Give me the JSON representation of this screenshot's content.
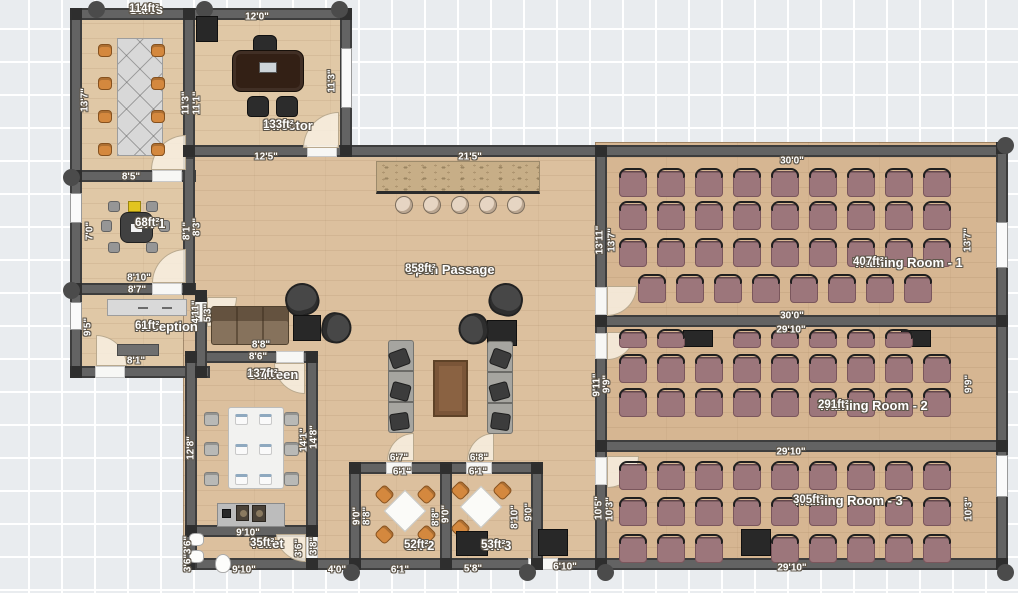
{
  "plan": {
    "title": "Office Floor Plan",
    "colors": {
      "canvas": "#e9ecef",
      "grid_line": "#ffffff",
      "wall": "#636363",
      "post": "#2e2e2e",
      "floor_offices": "#e0c8a6",
      "floor_passage": "#dcc09e",
      "floor_training": "#d6b692",
      "training_chair": "#9c767b",
      "orange_chair": "#d4883e",
      "accent_yellow": "#e2c41f",
      "label_text": "#ffffff",
      "label_outline": "#5f574b"
    },
    "rooms": [
      {
        "name": "Sales",
        "area": "114ft²",
        "cx": 129,
        "top": 3
      },
      {
        "name": "Director",
        "area": "133ft²",
        "cx": 263,
        "top": 119
      },
      {
        "name": "CR-1",
        "area": "68ft²",
        "cx": 135,
        "top": 217
      },
      {
        "name": "Reception",
        "area": "61ft²",
        "cx": 135,
        "top": 320
      },
      {
        "name": "Canteen",
        "area": "137ft²",
        "cx": 247,
        "top": 368
      },
      {
        "name": "Open Passage",
        "area": "858ft²",
        "cx": 405,
        "top": 263
      },
      {
        "name": "Toilet",
        "area": "35ft²",
        "cx": 250,
        "top": 537
      },
      {
        "name": "CR-2",
        "area": "52ft²",
        "cx": 404,
        "top": 539
      },
      {
        "name": "CR-3",
        "area": "53ft²",
        "cx": 481,
        "top": 539
      },
      {
        "name": "Training Room - 1",
        "area": "407ft²",
        "cx": 853,
        "top": 256
      },
      {
        "name": "Training Room - 2",
        "area": "291ft²",
        "cx": 818,
        "top": 399
      },
      {
        "name": "Training Room - 3",
        "area": "305ft²",
        "cx": 793,
        "top": 494
      }
    ],
    "dimensions": [
      {
        "text": "12'0\"",
        "x": 257,
        "y": 17,
        "vert": false
      },
      {
        "text": "12'5\"",
        "x": 266,
        "y": 157,
        "vert": false
      },
      {
        "text": "8'5\"",
        "x": 131,
        "y": 177,
        "vert": false
      },
      {
        "text": "8'10\"",
        "x": 139,
        "y": 278,
        "vert": false
      },
      {
        "text": "8'7\"",
        "x": 137,
        "y": 290,
        "vert": false
      },
      {
        "text": "8'1\"",
        "x": 136,
        "y": 361,
        "vert": false
      },
      {
        "text": "8'8\"",
        "x": 261,
        "y": 345,
        "vert": false
      },
      {
        "text": "8'6\"",
        "x": 258,
        "y": 357,
        "vert": false
      },
      {
        "text": "9'10\"",
        "x": 248,
        "y": 533,
        "vert": false
      },
      {
        "text": "9'10\"",
        "x": 244,
        "y": 570,
        "vert": false
      },
      {
        "text": "4'0\"",
        "x": 337,
        "y": 570,
        "vert": false
      },
      {
        "text": "6'1\"",
        "x": 400,
        "y": 570,
        "vert": false
      },
      {
        "text": "5'8\"",
        "x": 473,
        "y": 569,
        "vert": false
      },
      {
        "text": "6'10\"",
        "x": 565,
        "y": 567,
        "vert": false
      },
      {
        "text": "6'7\"",
        "x": 399,
        "y": 458,
        "vert": false
      },
      {
        "text": "6'1\"",
        "x": 402,
        "y": 472,
        "vert": false
      },
      {
        "text": "6'8\"",
        "x": 479,
        "y": 458,
        "vert": false
      },
      {
        "text": "6'1\"",
        "x": 478,
        "y": 472,
        "vert": false
      },
      {
        "text": "21'5\"",
        "x": 470,
        "y": 157,
        "vert": false
      },
      {
        "text": "30'0\"",
        "x": 792,
        "y": 161,
        "vert": false
      },
      {
        "text": "30'0\"",
        "x": 792,
        "y": 316,
        "vert": false
      },
      {
        "text": "29'10\"",
        "x": 791,
        "y": 330,
        "vert": false
      },
      {
        "text": "29'10\"",
        "x": 791,
        "y": 452,
        "vert": false
      },
      {
        "text": "29'10\"",
        "x": 792,
        "y": 568,
        "vert": false
      },
      {
        "text": "13'7\"",
        "x": 85,
        "y": 100,
        "vert": true
      },
      {
        "text": "11'3\"",
        "x": 186,
        "y": 103,
        "vert": true
      },
      {
        "text": "11'1\"",
        "x": 197,
        "y": 103,
        "vert": true
      },
      {
        "text": "11'3\"",
        "x": 332,
        "y": 81,
        "vert": true
      },
      {
        "text": "7'0\"",
        "x": 90,
        "y": 231,
        "vert": true
      },
      {
        "text": "8'1\"",
        "x": 187,
        "y": 231,
        "vert": true
      },
      {
        "text": "8'3\"",
        "x": 197,
        "y": 227,
        "vert": true
      },
      {
        "text": "9'5\"",
        "x": 88,
        "y": 327,
        "vert": true
      },
      {
        "text": "4'11\"",
        "x": 196,
        "y": 312,
        "vert": true
      },
      {
        "text": "5'3\"",
        "x": 208,
        "y": 313,
        "vert": true
      },
      {
        "text": "12'8\"",
        "x": 191,
        "y": 448,
        "vert": true
      },
      {
        "text": "14'1\"",
        "x": 304,
        "y": 440,
        "vert": true
      },
      {
        "text": "14'8\"",
        "x": 314,
        "y": 437,
        "vert": true
      },
      {
        "text": "3'6\"",
        "x": 188,
        "y": 545,
        "vert": true
      },
      {
        "text": "3'6\"",
        "x": 188,
        "y": 563,
        "vert": true
      },
      {
        "text": "3'6\"",
        "x": 299,
        "y": 548,
        "vert": true
      },
      {
        "text": "3'8\"",
        "x": 314,
        "y": 546,
        "vert": true
      },
      {
        "text": "9'0\"",
        "x": 357,
        "y": 516,
        "vert": true
      },
      {
        "text": "8'8\"",
        "x": 367,
        "y": 516,
        "vert": true
      },
      {
        "text": "8'8\"",
        "x": 436,
        "y": 517,
        "vert": true
      },
      {
        "text": "9'0\"",
        "x": 446,
        "y": 514,
        "vert": true
      },
      {
        "text": "8'10\"",
        "x": 515,
        "y": 517,
        "vert": true
      },
      {
        "text": "9'0\"",
        "x": 529,
        "y": 512,
        "vert": true
      },
      {
        "text": "13'11\"",
        "x": 600,
        "y": 240,
        "vert": true
      },
      {
        "text": "13'7\"",
        "x": 612,
        "y": 240,
        "vert": true
      },
      {
        "text": "13'7\"",
        "x": 968,
        "y": 240,
        "vert": true
      },
      {
        "text": "9'11\"",
        "x": 597,
        "y": 385,
        "vert": true
      },
      {
        "text": "9'9\"",
        "x": 607,
        "y": 384,
        "vert": true
      },
      {
        "text": "9'9\"",
        "x": 969,
        "y": 384,
        "vert": true
      },
      {
        "text": "10'5\"",
        "x": 599,
        "y": 508,
        "vert": true
      },
      {
        "text": "10'3\"",
        "x": 610,
        "y": 509,
        "vert": true
      },
      {
        "text": "10'3\"",
        "x": 969,
        "y": 509,
        "vert": true
      }
    ],
    "training": {
      "chair_w": 28,
      "chair_h": 26,
      "cols": [
        619,
        657,
        695,
        733,
        771,
        809,
        847,
        885,
        923
      ],
      "rows": [
        {
          "y": 171,
          "cols": [
            0,
            1,
            2,
            3,
            4,
            5,
            6,
            7,
            8
          ]
        },
        {
          "y": 204,
          "cols": [
            0,
            1,
            2,
            3,
            4,
            5,
            6,
            7,
            8
          ]
        },
        {
          "y": 241,
          "cols": [
            0,
            1,
            2,
            3,
            4,
            5,
            6,
            7,
            8
          ]
        },
        {
          "y": 277,
          "offset": 19,
          "cols": [
            0,
            1,
            2,
            3,
            4,
            5,
            6,
            7
          ]
        },
        {
          "y": 332,
          "h": 16,
          "cols": [
            0,
            1,
            3,
            4,
            5,
            6,
            7
          ]
        },
        {
          "y": 357,
          "cols": [
            0,
            1,
            2,
            3,
            4,
            5,
            6,
            7,
            8
          ]
        },
        {
          "y": 391,
          "cols": [
            0,
            1,
            2,
            3,
            4,
            5,
            6,
            7,
            8
          ]
        },
        {
          "y": 464,
          "cols": [
            0,
            1,
            2,
            3,
            4,
            5,
            6,
            7,
            8
          ]
        },
        {
          "y": 500,
          "cols": [
            0,
            1,
            2,
            3,
            4,
            5,
            6,
            7,
            8
          ]
        },
        {
          "y": 537,
          "cols": [
            0,
            1,
            2,
            4,
            5,
            6,
            7,
            8
          ]
        }
      ]
    },
    "furniture": [
      {
        "t": "desk-x",
        "x": 117,
        "y": 38,
        "w": 46,
        "h": 118
      },
      {
        "t": "chair-orange",
        "x": 98,
        "y": 44,
        "w": 14,
        "h": 13
      },
      {
        "t": "chair-orange",
        "x": 98,
        "y": 77,
        "w": 14,
        "h": 13
      },
      {
        "t": "chair-orange",
        "x": 98,
        "y": 110,
        "w": 14,
        "h": 13
      },
      {
        "t": "chair-orange",
        "x": 98,
        "y": 143,
        "w": 14,
        "h": 13
      },
      {
        "t": "chair-orange",
        "x": 151,
        "y": 44,
        "w": 14,
        "h": 13
      },
      {
        "t": "chair-orange",
        "x": 151,
        "y": 77,
        "w": 14,
        "h": 13
      },
      {
        "t": "chair-orange",
        "x": 151,
        "y": 110,
        "w": 14,
        "h": 13
      },
      {
        "t": "chair-orange",
        "x": 151,
        "y": 143,
        "w": 14,
        "h": 13
      },
      {
        "t": "cabinet-black",
        "x": 196,
        "y": 16,
        "w": 22,
        "h": 26
      },
      {
        "t": "chair-black",
        "x": 253,
        "y": 35,
        "w": 24,
        "h": 18
      },
      {
        "t": "desk-dark",
        "x": 232,
        "y": 50,
        "w": 72,
        "h": 42
      },
      {
        "t": "chair-black",
        "x": 247,
        "y": 96,
        "w": 22,
        "h": 21
      },
      {
        "t": "chair-black",
        "x": 276,
        "y": 96,
        "w": 22,
        "h": 21
      },
      {
        "t": "accent-yellow",
        "x": 128,
        "y": 201,
        "w": 13,
        "h": 11
      },
      {
        "t": "table-dark",
        "x": 120,
        "y": 212,
        "w": 33,
        "h": 31
      },
      {
        "t": "chair-gray",
        "x": 108,
        "y": 201,
        "w": 12,
        "h": 11
      },
      {
        "t": "chair-gray",
        "x": 146,
        "y": 201,
        "w": 12,
        "h": 11
      },
      {
        "t": "chair-gray",
        "x": 101,
        "y": 220,
        "w": 11,
        "h": 12
      },
      {
        "t": "chair-gray",
        "x": 159,
        "y": 220,
        "w": 11,
        "h": 12
      },
      {
        "t": "chair-gray",
        "x": 108,
        "y": 242,
        "w": 12,
        "h": 11
      },
      {
        "t": "chair-gray",
        "x": 146,
        "y": 242,
        "w": 12,
        "h": 11
      },
      {
        "t": "desk-light",
        "x": 107,
        "y": 299,
        "w": 80,
        "h": 17
      },
      {
        "t": "cabinet-gray",
        "x": 117,
        "y": 344,
        "w": 42,
        "h": 12
      },
      {
        "t": "sofa-brown",
        "x": 211,
        "y": 306,
        "w": 78,
        "h": 39
      },
      {
        "t": "armchair-dark",
        "x": 285,
        "y": 283,
        "w": 34,
        "h": 33,
        "r": -15
      },
      {
        "t": "sidetable-black",
        "x": 293,
        "y": 315,
        "w": 28,
        "h": 26
      },
      {
        "t": "armchair-dark",
        "x": 321,
        "y": 313,
        "w": 31,
        "h": 30,
        "r": 100
      },
      {
        "t": "armchair-dark",
        "x": 489,
        "y": 283,
        "w": 34,
        "h": 33,
        "r": 15
      },
      {
        "t": "sidetable-black",
        "x": 487,
        "y": 320,
        "w": 30,
        "h": 26
      },
      {
        "t": "armchair-dark",
        "x": 458,
        "y": 314,
        "w": 31,
        "h": 30,
        "r": -100
      },
      {
        "t": "counter-tan",
        "x": 376,
        "y": 161,
        "w": 164,
        "h": 33
      },
      {
        "t": "stool",
        "x": 395,
        "y": 196,
        "w": 18,
        "h": 18
      },
      {
        "t": "stool",
        "x": 423,
        "y": 196,
        "w": 18,
        "h": 18
      },
      {
        "t": "stool",
        "x": 451,
        "y": 196,
        "w": 18,
        "h": 18
      },
      {
        "t": "stool",
        "x": 479,
        "y": 196,
        "w": 18,
        "h": 18
      },
      {
        "t": "stool",
        "x": 507,
        "y": 196,
        "w": 18,
        "h": 18
      },
      {
        "t": "sofa-gray",
        "x": 388,
        "y": 340,
        "w": 26,
        "h": 93
      },
      {
        "t": "sofa-gray",
        "x": 487,
        "y": 341,
        "w": 26,
        "h": 93
      },
      {
        "t": "cushion-dark",
        "x": 390,
        "y": 350,
        "w": 19,
        "h": 17,
        "r": -20
      },
      {
        "t": "cushion-dark",
        "x": 391,
        "y": 383,
        "w": 19,
        "h": 17,
        "r": 15
      },
      {
        "t": "cushion-dark",
        "x": 390,
        "y": 413,
        "w": 19,
        "h": 17,
        "r": -8
      },
      {
        "t": "cushion-dark",
        "x": 491,
        "y": 350,
        "w": 19,
        "h": 17,
        "r": 20
      },
      {
        "t": "cushion-dark",
        "x": 490,
        "y": 383,
        "w": 19,
        "h": 17,
        "r": -15
      },
      {
        "t": "cushion-dark",
        "x": 491,
        "y": 413,
        "w": 19,
        "h": 17,
        "r": 8
      },
      {
        "t": "table-brown",
        "x": 433,
        "y": 360,
        "w": 35,
        "h": 57
      },
      {
        "t": "table-white",
        "x": 228,
        "y": 407,
        "w": 56,
        "h": 82
      },
      {
        "t": "chair-gray2",
        "x": 204,
        "y": 412,
        "w": 15,
        "h": 14
      },
      {
        "t": "chair-gray2",
        "x": 204,
        "y": 442,
        "w": 15,
        "h": 14
      },
      {
        "t": "chair-gray2",
        "x": 204,
        "y": 472,
        "w": 15,
        "h": 14
      },
      {
        "t": "chair-gray2",
        "x": 284,
        "y": 412,
        "w": 15,
        "h": 14
      },
      {
        "t": "chair-gray2",
        "x": 284,
        "y": 442,
        "w": 15,
        "h": 14
      },
      {
        "t": "chair-gray2",
        "x": 284,
        "y": 472,
        "w": 15,
        "h": 14
      },
      {
        "t": "setting",
        "x": 235,
        "y": 414,
        "w": 13,
        "h": 11
      },
      {
        "t": "setting",
        "x": 259,
        "y": 414,
        "w": 13,
        "h": 11
      },
      {
        "t": "setting",
        "x": 235,
        "y": 444,
        "w": 13,
        "h": 11
      },
      {
        "t": "setting",
        "x": 259,
        "y": 444,
        "w": 13,
        "h": 11
      },
      {
        "t": "setting",
        "x": 235,
        "y": 474,
        "w": 13,
        "h": 11
      },
      {
        "t": "setting",
        "x": 259,
        "y": 474,
        "w": 13,
        "h": 11
      },
      {
        "t": "counter-gray",
        "x": 217,
        "y": 503,
        "w": 68,
        "h": 24
      },
      {
        "t": "sink-dark",
        "x": 236,
        "y": 505,
        "w": 13,
        "h": 16
      },
      {
        "t": "sink-dark",
        "x": 252,
        "y": 505,
        "w": 14,
        "h": 17
      },
      {
        "t": "cabinet-black",
        "x": 222,
        "y": 509,
        "w": 9,
        "h": 9
      },
      {
        "t": "fixture-white",
        "x": 189,
        "y": 533,
        "w": 15,
        "h": 13
      },
      {
        "t": "fixture-white",
        "x": 189,
        "y": 550,
        "w": 15,
        "h": 13
      },
      {
        "t": "toilet-white",
        "x": 215,
        "y": 554,
        "w": 16,
        "h": 19
      },
      {
        "t": "table-diamond",
        "x": 390,
        "y": 496,
        "w": 30,
        "h": 30
      },
      {
        "t": "chair-orange",
        "x": 377,
        "y": 487,
        "w": 15,
        "h": 15,
        "r": 45
      },
      {
        "t": "chair-orange",
        "x": 419,
        "y": 487,
        "w": 15,
        "h": 15,
        "r": 45
      },
      {
        "t": "chair-orange",
        "x": 377,
        "y": 527,
        "w": 15,
        "h": 15,
        "r": 45
      },
      {
        "t": "chair-orange",
        "x": 419,
        "y": 527,
        "w": 15,
        "h": 15,
        "r": 45
      },
      {
        "t": "table-diamond",
        "x": 466,
        "y": 492,
        "w": 30,
        "h": 30
      },
      {
        "t": "chair-orange",
        "x": 453,
        "y": 483,
        "w": 15,
        "h": 15,
        "r": 45
      },
      {
        "t": "chair-orange",
        "x": 495,
        "y": 483,
        "w": 15,
        "h": 15,
        "r": 45
      },
      {
        "t": "chair-orange",
        "x": 453,
        "y": 521,
        "w": 15,
        "h": 15,
        "r": 45
      },
      {
        "t": "screen-black",
        "x": 456,
        "y": 531,
        "w": 32,
        "h": 25
      },
      {
        "t": "screen-black",
        "x": 538,
        "y": 529,
        "w": 30,
        "h": 27
      },
      {
        "t": "screen-black",
        "x": 683,
        "y": 330,
        "w": 30,
        "h": 17
      },
      {
        "t": "screen-black",
        "x": 901,
        "y": 330,
        "w": 30,
        "h": 17
      },
      {
        "t": "screen-black",
        "x": 741,
        "y": 529,
        "w": 30,
        "h": 27
      }
    ]
  }
}
